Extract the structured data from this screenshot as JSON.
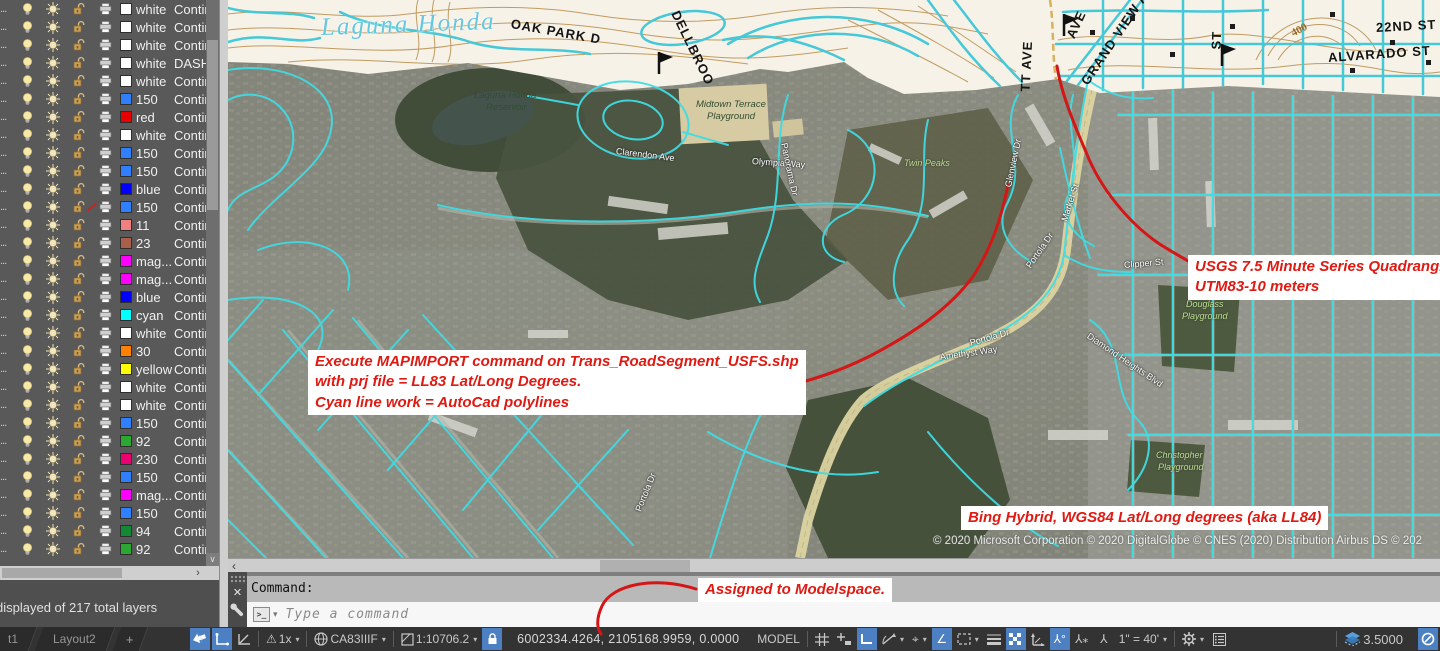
{
  "layer_panel": {
    "truncation": "...",
    "summary": "displayed of 217 total layers",
    "rows": [
      {
        "color": "white",
        "hex": "#ffffff",
        "linetype": "Continuous",
        "plot": true
      },
      {
        "color": "white",
        "hex": "#ffffff",
        "linetype": "Continuous",
        "plot": true
      },
      {
        "color": "white",
        "hex": "#ffffff",
        "linetype": "Continuous",
        "plot": true
      },
      {
        "color": "white",
        "hex": "#ffffff",
        "linetype": "DASHED",
        "plot": true
      },
      {
        "color": "white",
        "hex": "#ffffff",
        "linetype": "Continuous",
        "plot": true
      },
      {
        "color": "150",
        "hex": "#2f7fff",
        "linetype": "Continuous",
        "plot": true
      },
      {
        "color": "red",
        "hex": "#e80000",
        "linetype": "Continuous",
        "plot": true
      },
      {
        "color": "white",
        "hex": "#ffffff",
        "linetype": "Continuous",
        "plot": true
      },
      {
        "color": "150",
        "hex": "#2f7fff",
        "linetype": "Continuous",
        "plot": true
      },
      {
        "color": "150",
        "hex": "#2f7fff",
        "linetype": "Continuous",
        "plot": true
      },
      {
        "color": "blue",
        "hex": "#0000ff",
        "linetype": "Continuous",
        "plot": true
      },
      {
        "color": "150",
        "hex": "#2f7fff",
        "linetype": "Continuous",
        "plot": false
      },
      {
        "color": "11",
        "hex": "#f08080",
        "linetype": "Continuous",
        "plot": true
      },
      {
        "color": "23",
        "hex": "#a8604a",
        "linetype": "Continuous",
        "plot": true
      },
      {
        "color": "mag...",
        "hex": "#ff00ff",
        "linetype": "Continuous",
        "plot": true
      },
      {
        "color": "mag...",
        "hex": "#ff00ff",
        "linetype": "Continuous",
        "plot": true
      },
      {
        "color": "blue",
        "hex": "#0000ff",
        "linetype": "Continuous",
        "plot": true
      },
      {
        "color": "cyan",
        "hex": "#00ffff",
        "linetype": "Continuous",
        "plot": true
      },
      {
        "color": "white",
        "hex": "#ffffff",
        "linetype": "Continuous",
        "plot": true
      },
      {
        "color": "30",
        "hex": "#ff7f00",
        "linetype": "Continuous",
        "plot": true
      },
      {
        "color": "yellow",
        "hex": "#ffff00",
        "linetype": "Continuous",
        "plot": true
      },
      {
        "color": "white",
        "hex": "#ffffff",
        "linetype": "Continuous",
        "plot": true
      },
      {
        "color": "white",
        "hex": "#ffffff",
        "linetype": "Continuous",
        "plot": true
      },
      {
        "color": "150",
        "hex": "#2f7fff",
        "linetype": "Continuous",
        "plot": true
      },
      {
        "color": "92",
        "hex": "#2aa832",
        "linetype": "Continuous",
        "plot": true
      },
      {
        "color": "230",
        "hex": "#ea0070",
        "linetype": "Continuous",
        "plot": true
      },
      {
        "color": "150",
        "hex": "#2f7fff",
        "linetype": "Continuous",
        "plot": true
      },
      {
        "color": "mag...",
        "hex": "#ff00ff",
        "linetype": "Continuous",
        "plot": true
      },
      {
        "color": "150",
        "hex": "#2f7fff",
        "linetype": "Continuous",
        "plot": true
      },
      {
        "color": "94",
        "hex": "#128a35",
        "linetype": "Continuous",
        "plot": true
      },
      {
        "color": "92",
        "hex": "#2aa832",
        "linetype": "Continuous",
        "plot": true
      },
      {
        "color": "white",
        "hex": "#ffffff",
        "linetype": "Continuous",
        "plot": false
      }
    ]
  },
  "layout_tabs": {
    "partial": "t1",
    "tab2": "Layout2",
    "add": "+"
  },
  "command_panel": {
    "history": "Command:",
    "prompt_icon": ">_",
    "placeholder": "Type a command"
  },
  "callouts": {
    "usgs": {
      "line1": "USGS 7.5 Minute Series Quadrangle",
      "line2": "UTM83-10 meters"
    },
    "mapimport": {
      "line1": "Execute MAPIMPORT command on Trans_RoadSegment_USFS.shp",
      "line2": "with prj file = LL83 Lat/Long Degrees.",
      "line3": "Cyan line work = AutoCad polylines"
    },
    "bing": {
      "line1": "Bing Hybrid, WGS84 Lat/Long degrees (aka LL84)"
    },
    "modelspace": {
      "line1": "Assigned to Modelspace."
    }
  },
  "map": {
    "copyright": "© 2020 Microsoft Corporation © 2020 DigitalGlobe © CNES (2020) Distribution Airbus DS © 202",
    "labels": [
      {
        "t": "Laguna Honda",
        "x": 93,
        "y": 14,
        "r": -2,
        "c": "lake"
      },
      {
        "t": "OAK PARK D",
        "x": 283,
        "y": 16,
        "r": 10,
        "c": "topo"
      },
      {
        "t": "DELLBROO",
        "x": 447,
        "y": 4,
        "r": 64,
        "c": "topo"
      },
      {
        "t": "GRAND VIEW A",
        "x": 856,
        "y": 76,
        "r": -56,
        "c": "topo"
      },
      {
        "t": "TT AVE",
        "x": 797,
        "y": 84,
        "r": -87,
        "c": "topo"
      },
      {
        "t": "AVE",
        "x": 842,
        "y": 30,
        "r": -65,
        "c": "topo"
      },
      {
        "t": "ST",
        "x": 988,
        "y": 42,
        "r": -88,
        "c": "topo"
      },
      {
        "t": "22ND ST",
        "x": 1148,
        "y": 20,
        "r": -3,
        "c": "topo"
      },
      {
        "t": "ALVARADO ST",
        "x": 1100,
        "y": 50,
        "r": -4,
        "c": "topo"
      },
      {
        "t": "400",
        "x": 1064,
        "y": 28,
        "r": -28,
        "c": "contour"
      },
      {
        "t": "Laguna Honda",
        "x": 246,
        "y": 90,
        "r": 0,
        "c": "park2"
      },
      {
        "t": "Reservoir",
        "x": 258,
        "y": 102,
        "r": 0,
        "c": "park2"
      },
      {
        "t": "Midtown Terrace",
        "x": 468,
        "y": 99,
        "r": 0,
        "c": "park2"
      },
      {
        "t": "Playground",
        "x": 479,
        "y": 111,
        "r": 0,
        "c": "park2"
      },
      {
        "t": "Twin Peaks",
        "x": 676,
        "y": 158,
        "r": 0,
        "c": "park"
      },
      {
        "t": "Clarendon Ave",
        "x": 388,
        "y": 146,
        "r": 7,
        "c": "street"
      },
      {
        "t": "Olympia Way",
        "x": 524,
        "y": 156,
        "r": 4,
        "c": "street"
      },
      {
        "t": "Panorama Dr",
        "x": 556,
        "y": 138,
        "r": 78,
        "c": "street"
      },
      {
        "t": "Glenview Dr",
        "x": 780,
        "y": 182,
        "r": -78,
        "c": "street"
      },
      {
        "t": "Market St",
        "x": 836,
        "y": 216,
        "r": -72,
        "c": "street"
      },
      {
        "t": "Portola Dr",
        "x": 800,
        "y": 262,
        "r": -55,
        "c": "street"
      },
      {
        "t": "Portola Dr",
        "x": 742,
        "y": 338,
        "r": -16,
        "c": "street"
      },
      {
        "t": "Portola Dr",
        "x": 410,
        "y": 506,
        "r": -68,
        "c": "street"
      },
      {
        "t": "Clipper St",
        "x": 896,
        "y": 260,
        "r": -5,
        "c": "street"
      },
      {
        "t": "Amethyst Way",
        "x": 712,
        "y": 352,
        "r": -8,
        "c": "street"
      },
      {
        "t": "Diamond Heights Blvd",
        "x": 860,
        "y": 330,
        "r": 34,
        "c": "street"
      },
      {
        "t": "Douglass",
        "x": 958,
        "y": 299,
        "r": 0,
        "c": "park"
      },
      {
        "t": "Playground",
        "x": 954,
        "y": 311,
        "r": 0,
        "c": "park"
      },
      {
        "t": "Christopher",
        "x": 928,
        "y": 450,
        "r": 0,
        "c": "park"
      },
      {
        "t": "Playground",
        "x": 930,
        "y": 462,
        "r": 0,
        "c": "park"
      }
    ]
  },
  "status_bar": {
    "warn_scale": "1x",
    "coordinate_system": "CA83IIIF",
    "viewport_scale": "1:10706.2",
    "coordinates": "6002334.4264, 2105168.9959, 0.0000",
    "model": "MODEL",
    "annotation_scale": "1\" = 40'",
    "elevation": "3.5000"
  }
}
